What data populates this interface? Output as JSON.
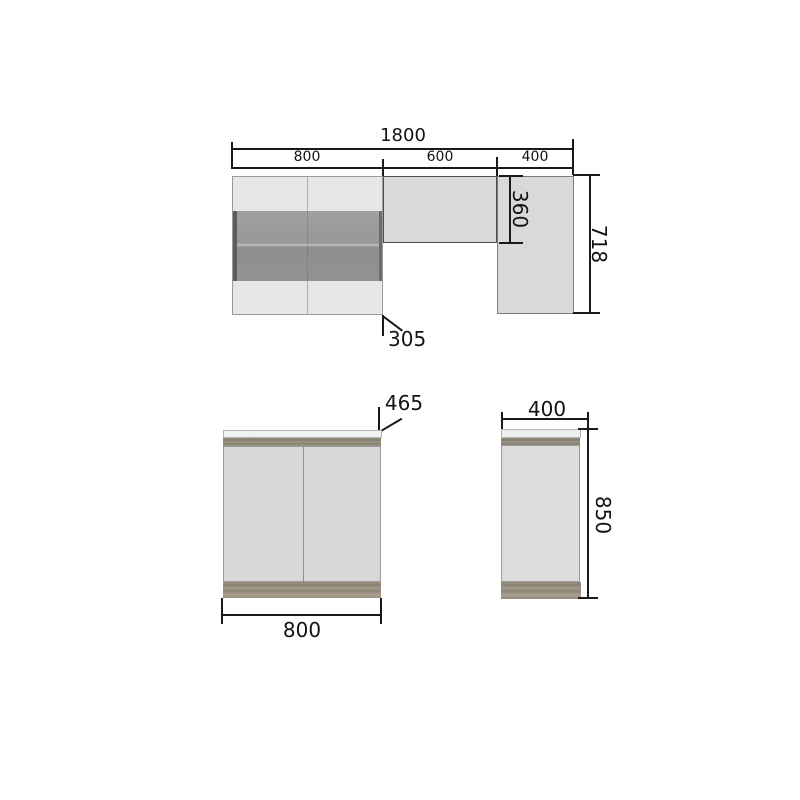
{
  "diagram": {
    "top_view": {
      "overall_width": "1800",
      "segments": [
        {
          "label": "800"
        },
        {
          "label": "600"
        },
        {
          "label": "400"
        }
      ],
      "overall_height": "718",
      "upper_section_height": "360",
      "depth_callout": "305"
    },
    "front_view": {
      "width": "800",
      "depth_callout": "465"
    },
    "side_view": {
      "width": "400",
      "height": "850"
    },
    "colors": {
      "line": "#1a1a1a",
      "text": "#131313",
      "cabinet_light": "#e7e7e7",
      "cabinet_mid": "#d9d9d9",
      "glass_dark": "#9a9a9a",
      "glass_edge": "#5c5c5c",
      "wood": "#948c7b",
      "countertop": "#f1f1f1",
      "background": "#ffffff"
    }
  }
}
